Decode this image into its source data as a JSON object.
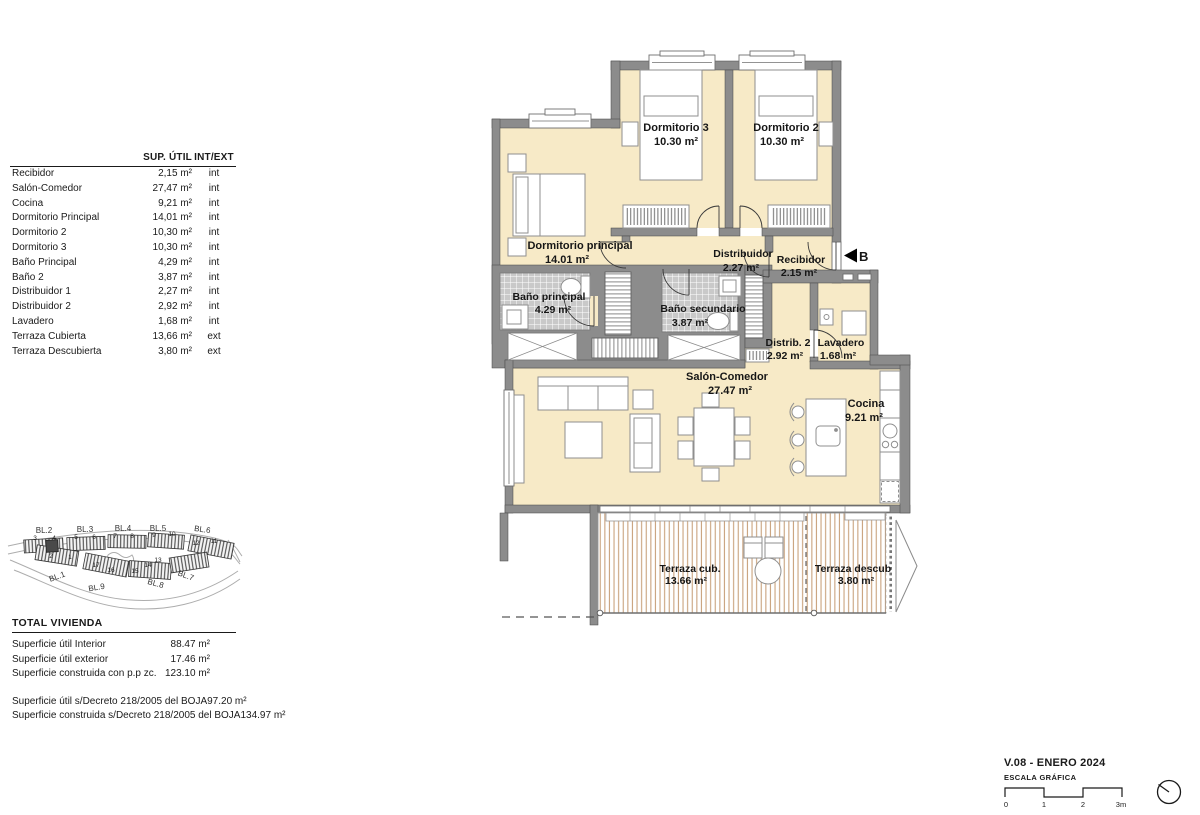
{
  "left_table": {
    "header": {
      "col_area": "SUP. ÚTIL",
      "col_intext": "INT/EXT"
    },
    "rows": [
      {
        "name": "Recibidor",
        "area": "2,15 m²",
        "type": "int"
      },
      {
        "name": "Salón-Comedor",
        "area": "27,47 m²",
        "type": "int"
      },
      {
        "name": "Cocina",
        "area": "9,21 m²",
        "type": "int"
      },
      {
        "name": "Dormitorio Principal",
        "area": "14,01 m²",
        "type": "int"
      },
      {
        "name": "Dormitorio 2",
        "area": "10,30 m²",
        "type": "int"
      },
      {
        "name": "Dormitorio 3",
        "area": "10,30 m²",
        "type": "int"
      },
      {
        "name": "Baño Principal",
        "area": "4,29 m²",
        "type": "int"
      },
      {
        "name": "Baño 2",
        "area": "3,87 m²",
        "type": "int"
      },
      {
        "name": "Distribuidor 1",
        "area": "2,27 m²",
        "type": "int"
      },
      {
        "name": "Distribuidor 2",
        "area": "2,92 m²",
        "type": "int"
      },
      {
        "name": "Lavadero",
        "area": "1,68 m²",
        "type": "int"
      },
      {
        "name": "Terraza Cubierta",
        "area": "13,66 m²",
        "type": "ext"
      },
      {
        "name": "Terraza Descubierta",
        "area": "3,80 m²",
        "type": "ext"
      }
    ]
  },
  "totals": {
    "title": "TOTAL VIVIENDA",
    "rows": [
      {
        "label": "Superficie útil Interior",
        "value": "88.47 m²"
      },
      {
        "label": "Superficie útil exterior",
        "value": "17.46 m²"
      },
      {
        "label": "Superficie construida con p.p zc.",
        "value": "123.10 m²"
      }
    ],
    "boja_rows": [
      {
        "label": "Superficie útil s/Decreto 218/2005 del BOJA",
        "value": "97.20 m²"
      },
      {
        "label": "Superficie construida s/Decreto 218/2005 del BOJA",
        "value": "134.97 m²"
      }
    ]
  },
  "site_plan": {
    "blocks_top": [
      "BL.2",
      "BL.3",
      "BL.4",
      "BL.5",
      "BL.6"
    ],
    "blocks_bottom": [
      "BL.1",
      "BL.9",
      "BL.8",
      "BL.7"
    ],
    "unit_numbers": [
      "3",
      "4",
      "5",
      "6",
      "7",
      "8",
      "9",
      "10",
      "12",
      "11",
      "2",
      "1",
      "17",
      "16",
      "15",
      "14",
      "13"
    ]
  },
  "plan": {
    "rooms": [
      {
        "name": "Dormitorio 3",
        "area": "10.30 m²"
      },
      {
        "name": "Dormitorio 2",
        "area": "10.30 m²"
      },
      {
        "name": "Dormitorio principal",
        "area": "14.01 m²"
      },
      {
        "name": "Baño principal",
        "area": "4.29 m²"
      },
      {
        "name": "Baño secundario",
        "area": "3.87 m²"
      },
      {
        "name": "Distribuidor",
        "area": "2.27 m²"
      },
      {
        "name": "Recibidor",
        "area": "2.15 m²"
      },
      {
        "name": "Distrib. 2",
        "area": "2.92 m²"
      },
      {
        "name": "Lavadero",
        "area": "1.68 m²"
      },
      {
        "name": "Salón-Comedor",
        "area": "27.47 m²"
      },
      {
        "name": "Cocina",
        "area": "9.21 m²"
      },
      {
        "name": "Terraza cub.",
        "area": "13.66 m²"
      },
      {
        "name": "Terraza descub",
        "area": "3.80 m²"
      }
    ],
    "entrance_label": "B"
  },
  "footer": {
    "version": "V.08 - ENERO 2024",
    "scale_title": "ESCALA GRÁFICA",
    "scale_ticks": [
      "0",
      "1",
      "2",
      "3m"
    ]
  },
  "colors": {
    "room_fill": "#f7eac7",
    "wall": "#8c8c8c",
    "tile": "#c9c9c9",
    "deck_line": "#c9a27d",
    "text": "#1a1a1a"
  }
}
